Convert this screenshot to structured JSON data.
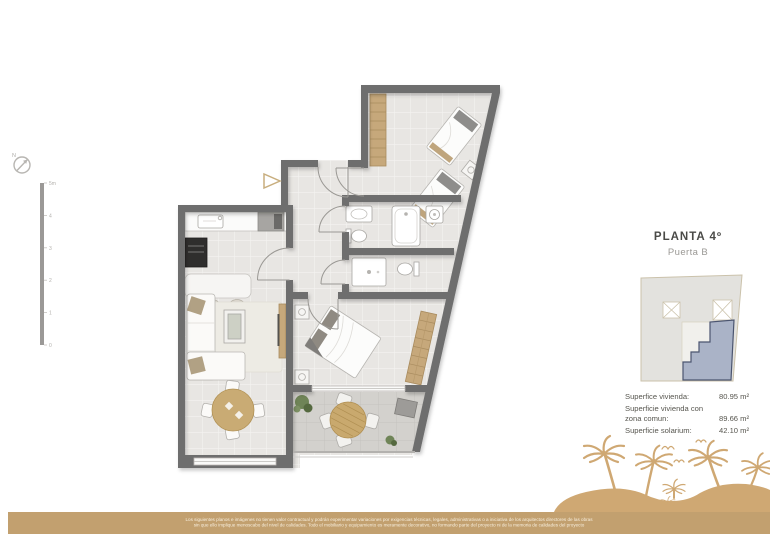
{
  "colors": {
    "wall_gray": "#6e6e6e",
    "floor_tile": "#e8e6e3",
    "terrace_tile": "#d3d1cd",
    "wood_accent": "#c6a87b",
    "brand_tan": "#c2a06f",
    "palm_tan": "#cfa873",
    "keyplan_unit_fill": "#aab3c7",
    "keyplan_unit_stroke": "#4b5570"
  },
  "compass": {
    "north_label": "N"
  },
  "scale_bar": {
    "labels": [
      "5m",
      "4",
      "3",
      "2",
      "1",
      "0"
    ]
  },
  "panel": {
    "title": "PLANTA 4º",
    "subtitle": "Puerta B",
    "areas": [
      {
        "label_line1": "Superfice vivienda:",
        "label_line2": "",
        "value": "80.95 m²"
      },
      {
        "label_line1": "Superficie vivienda con",
        "label_line2": "zona comun:",
        "value": "89.66 m²"
      },
      {
        "label_line1": "Superficie solarium:",
        "label_line2": "",
        "value": "42.10 m²"
      }
    ]
  },
  "footer": {
    "disclaimer_line1": "Los siguientes planos e imágenes no tienen valor contractual y podrán experimentar variaciones por exigencias técnicas, legales, administrativas o a iniciativa de los arquitectos directores de las obras",
    "disclaimer_line2": "sin que ello implique menoscabo del nivel de calidades. Todo el mobiliario y equipamiento es meramente decorativo, no formando parte del proyecto ni de la memoria de calidades del proyecto"
  }
}
